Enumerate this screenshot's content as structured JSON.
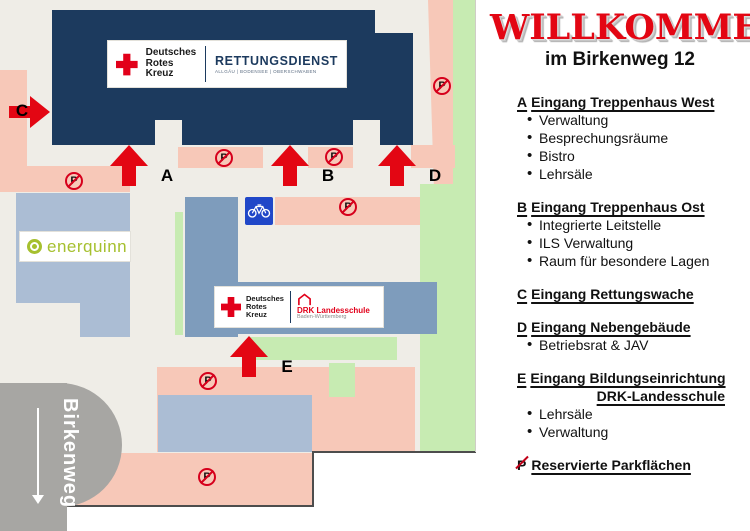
{
  "panel": {
    "title": "WILLKOMMEN",
    "subtitle": "im Birkenweg 12",
    "sections": [
      {
        "letter": "A",
        "heading": "Eingang Treppenhaus West",
        "items": [
          "Verwaltung",
          "Besprechungsräume",
          "Bistro",
          "Lehrsäle"
        ]
      },
      {
        "letter": "B",
        "heading": "Eingang Treppenhaus Ost",
        "items": [
          "Integrierte Leitstelle",
          "ILS Verwaltung",
          "Raum für besondere Lagen"
        ]
      },
      {
        "letter": "C",
        "heading": "Eingang Rettungswache",
        "items": []
      },
      {
        "letter": "D",
        "heading": "Eingang Nebengebäude",
        "items": [
          "Betriebsrat & JAV"
        ]
      },
      {
        "letter": "E",
        "heading": "Eingang Bildungseinrichtung",
        "heading2": "DRK-Landesschule",
        "items": [
          "Lehrsäle",
          "Verwaltung"
        ]
      },
      {
        "letter": "P",
        "heading": "Reservierte Parkflächen",
        "items": []
      }
    ]
  },
  "map": {
    "street_name": "Birkenweg",
    "parking_letter": "P",
    "arrows": [
      {
        "label": "A"
      },
      {
        "label": "B"
      },
      {
        "label": "C"
      },
      {
        "label": "D"
      },
      {
        "label": "E"
      }
    ],
    "logo_drk": {
      "l1": "Deutsches",
      "l2": "Rotes",
      "l3": "Kreuz"
    },
    "logo_rettungsdienst": {
      "title": "RETTUNGSDIENST",
      "subtitle": "ALLGÄU | BODENSEE | OBERSCHWABEN"
    },
    "logo_landesschule": {
      "title": "DRK Landesschule",
      "subtitle": "Baden-Württemberg"
    },
    "logo_enerquinn": {
      "text": "enerquinn"
    },
    "colors": {
      "building_navy": "#1c3a5e",
      "building_blue_light": "#abbdd4",
      "building_blue_medium": "#7e9cbc",
      "parking_pink": "#f7c8b8",
      "lawn_green": "#c7ebb2",
      "street_gray": "#a7a6a3",
      "arrow_red": "#e30613",
      "sign_red": "#d6001c",
      "enerquinn_green": "#a6c02f",
      "bike_sign_blue": "#2047c8",
      "background_beige": "#efede7"
    }
  }
}
